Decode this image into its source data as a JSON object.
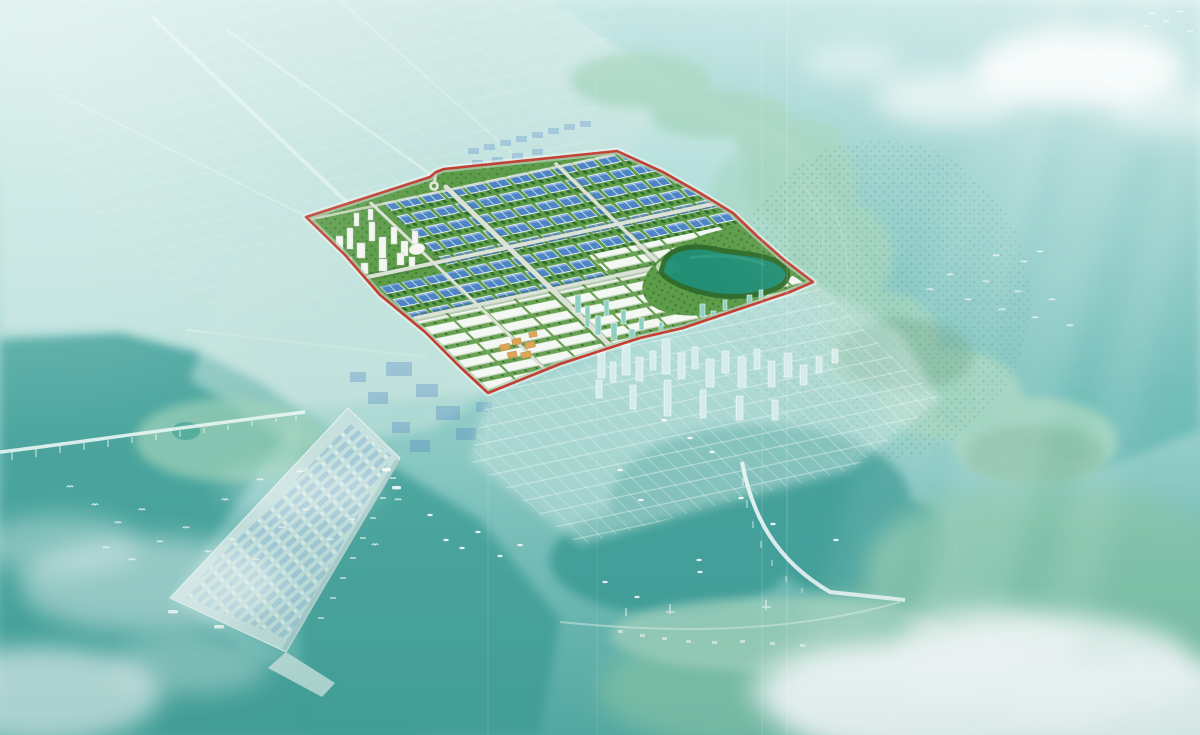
{
  "scene": {
    "kind": "aerial-masterplan-rendering",
    "subject": "coastal industrial park master plan with red highlighted development boundary; surroundings shown desaturated in teal haze",
    "visible_text": "none",
    "features": [
      "site-boundary-red",
      "industrial-park-site",
      "factory-rows-blue-roofs",
      "white-plot-rows",
      "cbd-tower-cluster",
      "teal-tower-cluster",
      "orange-roof-clusters",
      "central-lake",
      "site-roads",
      "roundabout",
      "washed-city-district",
      "washed-city-towers",
      "seaport-pier",
      "container-yard",
      "west-bridge",
      "curved-bridge",
      "resort-shore-strip",
      "island-hills",
      "southeast-forest",
      "ocean",
      "left-sea",
      "southeast-bay",
      "clouds",
      "sun-rays",
      "bird-flocks",
      "boats",
      "fold-lines"
    ]
  },
  "site": {
    "boundary_points": "306,217 430,177 436,172 444,169 617,151 663,172 700,193 733,213 758,237 783,259 813,282 790,292 683,328 640,338 560,364 488,393 460,367 425,332 380,295 345,255",
    "zones": [
      "factory-rows",
      "white-plots",
      "cbd-towers",
      "teal-towers",
      "villa-rows",
      "lake",
      "tree-belts"
    ]
  },
  "colors": {
    "sky_haze": "#cdebe9",
    "water_light": "#a9d9d5",
    "water_mid": "#7fc2bd",
    "water_bottom": "#5cb0a9",
    "ocean_light": "#b9e2e0",
    "ocean_deep": "#64b6b1",
    "water_deep": "#46a39c",
    "bay_deep": "#3f9e98",
    "land_wash": "#c6e4df",
    "island_green_wash": "#9ed2b9",
    "forest_wash": "#86c5ab",
    "site_green": "#5d9c49",
    "tree_dark": "#2f6b2c",
    "factory_roof_blue": "#4c84c4",
    "factory_roof_light": "#7fa9dc",
    "factory_wall_white": "#eef3f8",
    "plot_white": "#f4f8f2",
    "road_light": "#dde2d6",
    "lake_green": "#1f8f78",
    "boundary_red": "#c23a2c",
    "boundary_halo": "#f6fbf9",
    "cbd_tower_white": "#f3f6f1",
    "teal_tower": "#8ed1c4",
    "orange_roof": "#dca558",
    "washed_tower": "#d9edee",
    "container_blue": "#74a9cf",
    "pier_wash": "#c9e2df",
    "bridge_white": "#e9f6f4",
    "cloud_white": "#ffffff",
    "bird_white": "#ffffff"
  }
}
